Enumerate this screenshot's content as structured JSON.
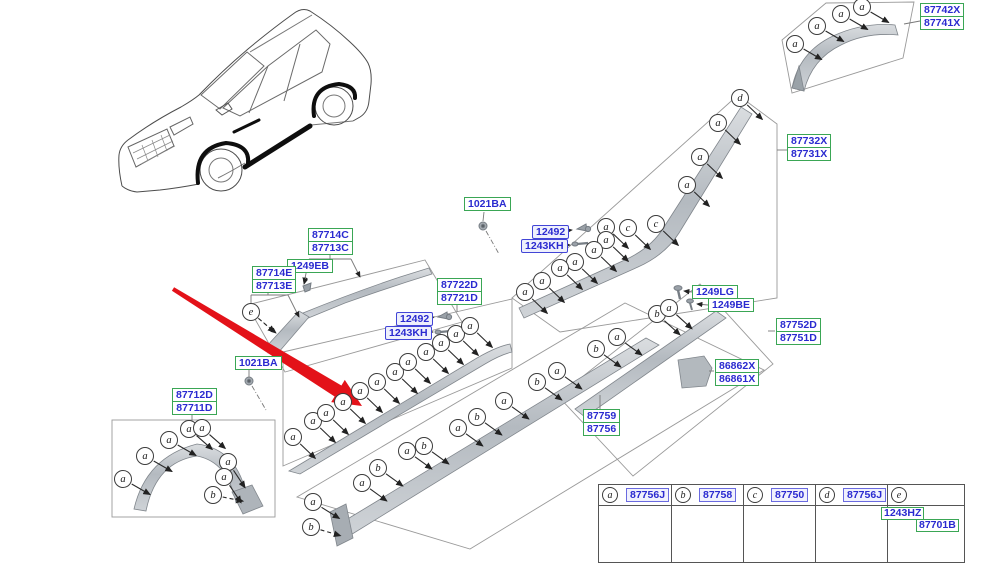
{
  "colors": {
    "part_link_blue": "#2a2ad0",
    "box_green": "#3aa655",
    "box_blue": "#4245d6",
    "red_arrow": "#e31219",
    "part_gray": "#b9bfc5",
    "line_gray": "#9a9a9a"
  },
  "diagram": {
    "labels": [
      {
        "style": "green",
        "x": 920,
        "y": 3,
        "lines": [
          "87742X",
          "87741X"
        ]
      },
      {
        "style": "green",
        "x": 787,
        "y": 134,
        "lines": [
          "87732X",
          "87731X"
        ]
      },
      {
        "style": "green",
        "x": 308,
        "y": 228,
        "lines": [
          "87714C",
          "87713C"
        ]
      },
      {
        "style": "green",
        "x": 287,
        "y": 259,
        "lines": [
          "1249EB"
        ]
      },
      {
        "style": "green",
        "x": 252,
        "y": 266,
        "lines": [
          "87714E",
          "87713E"
        ]
      },
      {
        "style": "green",
        "x": 464,
        "y": 197,
        "lines": [
          "1021BA"
        ]
      },
      {
        "style": "blue",
        "x": 532,
        "y": 225,
        "lines": [
          "12492"
        ]
      },
      {
        "style": "blue",
        "x": 521,
        "y": 239,
        "lines": [
          "1243KH"
        ]
      },
      {
        "style": "green",
        "x": 437,
        "y": 278,
        "lines": [
          "87722D",
          "87721D"
        ]
      },
      {
        "style": "blue",
        "x": 396,
        "y": 312,
        "lines": [
          "12492"
        ]
      },
      {
        "style": "blue",
        "x": 385,
        "y": 326,
        "lines": [
          "1243KH"
        ]
      },
      {
        "style": "green",
        "x": 235,
        "y": 356,
        "lines": [
          "1021BA"
        ]
      },
      {
        "style": "green",
        "x": 692,
        "y": 285,
        "lines": [
          "1249LG"
        ]
      },
      {
        "style": "green",
        "x": 708,
        "y": 298,
        "lines": [
          "1249BE"
        ]
      },
      {
        "style": "green",
        "x": 776,
        "y": 318,
        "lines": [
          "87752D",
          "87751D"
        ]
      },
      {
        "style": "green",
        "x": 715,
        "y": 359,
        "lines": [
          "86862X",
          "86861X"
        ]
      },
      {
        "style": "green",
        "x": 583,
        "y": 409,
        "lines": [
          "87759",
          "87756"
        ]
      },
      {
        "style": "green",
        "x": 172,
        "y": 388,
        "lines": [
          "87712D",
          "87711D"
        ]
      }
    ],
    "callouts": [
      {
        "l": "a",
        "x": 795,
        "y": 44,
        "dx": 0.86,
        "dy": 0.5
      },
      {
        "l": "a",
        "x": 817,
        "y": 26,
        "dx": 0.86,
        "dy": 0.5
      },
      {
        "l": "a",
        "x": 841,
        "y": 14,
        "dx": 0.86,
        "dy": 0.5
      },
      {
        "l": "a",
        "x": 862,
        "y": 7,
        "dx": 0.86,
        "dy": 0.5
      },
      {
        "l": "d",
        "x": 740,
        "y": 98,
        "dx": 0.72,
        "dy": 0.69
      },
      {
        "l": "a",
        "x": 718,
        "y": 123,
        "dx": 0.72,
        "dy": 0.69
      },
      {
        "l": "a",
        "x": 700,
        "y": 157,
        "dx": 0.72,
        "dy": 0.69
      },
      {
        "l": "a",
        "x": 687,
        "y": 185,
        "dx": 0.72,
        "dy": 0.69
      },
      {
        "l": "c",
        "x": 656,
        "y": 224,
        "dx": 0.72,
        "dy": 0.69
      },
      {
        "l": "c",
        "x": 628,
        "y": 228,
        "dx": 0.72,
        "dy": 0.69
      },
      {
        "l": "a",
        "x": 606,
        "y": 227,
        "dx": 0.72,
        "dy": 0.69
      },
      {
        "l": "a",
        "x": 606,
        "y": 240,
        "dx": 0.72,
        "dy": 0.69
      },
      {
        "l": "a",
        "x": 594,
        "y": 250,
        "dx": 0.72,
        "dy": 0.69
      },
      {
        "l": "a",
        "x": 575,
        "y": 262,
        "dx": 0.72,
        "dy": 0.69
      },
      {
        "l": "a",
        "x": 560,
        "y": 268,
        "dx": 0.72,
        "dy": 0.69
      },
      {
        "l": "a",
        "x": 542,
        "y": 281,
        "dx": 0.72,
        "dy": 0.69
      },
      {
        "l": "a",
        "x": 525,
        "y": 292,
        "dx": 0.72,
        "dy": 0.69
      },
      {
        "l": "e",
        "x": 251,
        "y": 312,
        "dx": 0.76,
        "dy": 0.65,
        "dash": true
      },
      {
        "l": "a",
        "x": 293,
        "y": 437,
        "dx": 0.72,
        "dy": 0.69
      },
      {
        "l": "a",
        "x": 313,
        "y": 421,
        "dx": 0.72,
        "dy": 0.69
      },
      {
        "l": "a",
        "x": 326,
        "y": 413,
        "dx": 0.72,
        "dy": 0.69
      },
      {
        "l": "a",
        "x": 343,
        "y": 402,
        "dx": 0.72,
        "dy": 0.69
      },
      {
        "l": "a",
        "x": 360,
        "y": 391,
        "dx": 0.72,
        "dy": 0.69
      },
      {
        "l": "a",
        "x": 377,
        "y": 382,
        "dx": 0.72,
        "dy": 0.69
      },
      {
        "l": "a",
        "x": 395,
        "y": 372,
        "dx": 0.72,
        "dy": 0.69
      },
      {
        "l": "a",
        "x": 408,
        "y": 362,
        "dx": 0.72,
        "dy": 0.69
      },
      {
        "l": "a",
        "x": 426,
        "y": 352,
        "dx": 0.72,
        "dy": 0.69
      },
      {
        "l": "a",
        "x": 441,
        "y": 343,
        "dx": 0.72,
        "dy": 0.69
      },
      {
        "l": "a",
        "x": 456,
        "y": 334,
        "dx": 0.72,
        "dy": 0.69
      },
      {
        "l": "a",
        "x": 470,
        "y": 326,
        "dx": 0.72,
        "dy": 0.69
      },
      {
        "l": "a",
        "x": 313,
        "y": 502,
        "dx": 0.85,
        "dy": 0.53
      },
      {
        "l": "b",
        "x": 311,
        "y": 527,
        "dx": 0.95,
        "dy": 0.28,
        "dash": true
      },
      {
        "l": "a",
        "x": 362,
        "y": 483,
        "dx": 0.8,
        "dy": 0.58
      },
      {
        "l": "b",
        "x": 378,
        "y": 468,
        "dx": 0.8,
        "dy": 0.58
      },
      {
        "l": "a",
        "x": 407,
        "y": 451,
        "dx": 0.8,
        "dy": 0.58
      },
      {
        "l": "b",
        "x": 424,
        "y": 446,
        "dx": 0.8,
        "dy": 0.58
      },
      {
        "l": "a",
        "x": 458,
        "y": 428,
        "dx": 0.8,
        "dy": 0.58
      },
      {
        "l": "b",
        "x": 477,
        "y": 417,
        "dx": 0.8,
        "dy": 0.58
      },
      {
        "l": "a",
        "x": 504,
        "y": 401,
        "dx": 0.8,
        "dy": 0.58
      },
      {
        "l": "b",
        "x": 537,
        "y": 382,
        "dx": 0.8,
        "dy": 0.58
      },
      {
        "l": "a",
        "x": 557,
        "y": 371,
        "dx": 0.8,
        "dy": 0.58
      },
      {
        "l": "b",
        "x": 596,
        "y": 349,
        "dx": 0.8,
        "dy": 0.58
      },
      {
        "l": "a",
        "x": 617,
        "y": 337,
        "dx": 0.8,
        "dy": 0.58
      },
      {
        "l": "b",
        "x": 657,
        "y": 314,
        "dx": 0.74,
        "dy": 0.67
      },
      {
        "l": "a",
        "x": 669,
        "y": 308,
        "dx": 0.74,
        "dy": 0.67
      },
      {
        "l": "a",
        "x": 123,
        "y": 479,
        "dx": 0.87,
        "dy": 0.5
      },
      {
        "l": "a",
        "x": 145,
        "y": 456,
        "dx": 0.87,
        "dy": 0.5
      },
      {
        "l": "a",
        "x": 169,
        "y": 440,
        "dx": 0.87,
        "dy": 0.5
      },
      {
        "l": "a",
        "x": 189,
        "y": 429,
        "dx": 0.75,
        "dy": 0.66
      },
      {
        "l": "a",
        "x": 202,
        "y": 428,
        "dx": 0.75,
        "dy": 0.66
      },
      {
        "l": "a",
        "x": 228,
        "y": 462,
        "dx": 0.55,
        "dy": 0.83
      },
      {
        "l": "a",
        "x": 224,
        "y": 477,
        "dx": 0.55,
        "dy": 0.83
      },
      {
        "l": "b",
        "x": 213,
        "y": 495,
        "dx": 0.97,
        "dy": 0.2,
        "dash": true
      }
    ],
    "legend": {
      "cells": [
        {
          "letter": "a",
          "part": "87756J"
        },
        {
          "letter": "b",
          "part": "87758"
        },
        {
          "letter": "c",
          "part": "87750"
        },
        {
          "letter": "d",
          "part": "87756J"
        },
        {
          "letter": "e",
          "part1": "1243HZ",
          "part2": "87701B"
        }
      ]
    }
  }
}
